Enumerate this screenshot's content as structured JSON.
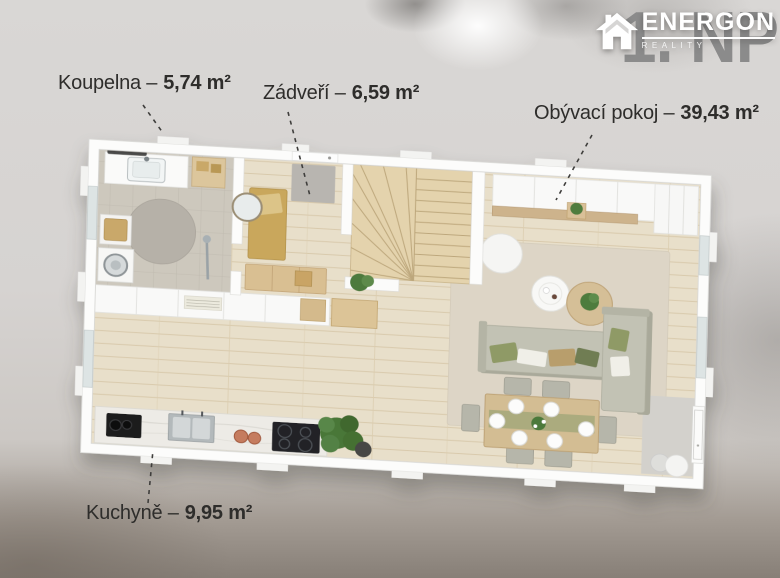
{
  "title": {
    "floor": "1. NP"
  },
  "logo": {
    "brand": "ENERGON",
    "sub": "REALITY",
    "icon": "house-icon"
  },
  "labels": [
    {
      "room": "koupelna",
      "name": "Koupelna –",
      "area": "5,74 m²"
    },
    {
      "room": "zadveri",
      "name": "Zádveří –",
      "area": "6,59 m²"
    },
    {
      "room": "obyvaci-pokoj",
      "name": "Obývací pokoj –",
      "area": "39,43 m²"
    },
    {
      "room": "kuchyne",
      "name": "Kuchyně –",
      "area": "9,95 m²"
    }
  ],
  "colors": {
    "label_text": "#2e2d2b",
    "floor_title": "#8b8b8b",
    "logo": "#ffffff",
    "wood_floor": "#e8dfca",
    "bath_tile": "#cdc8bd",
    "stair_wood": "#e4d3ad",
    "rug": "#ddd5c6",
    "sofa": "#c2c2b4",
    "dining_table": "#d3bd93",
    "counter": "#edebe6",
    "plant": "#4a7739",
    "wall": "#fcfcfb"
  }
}
